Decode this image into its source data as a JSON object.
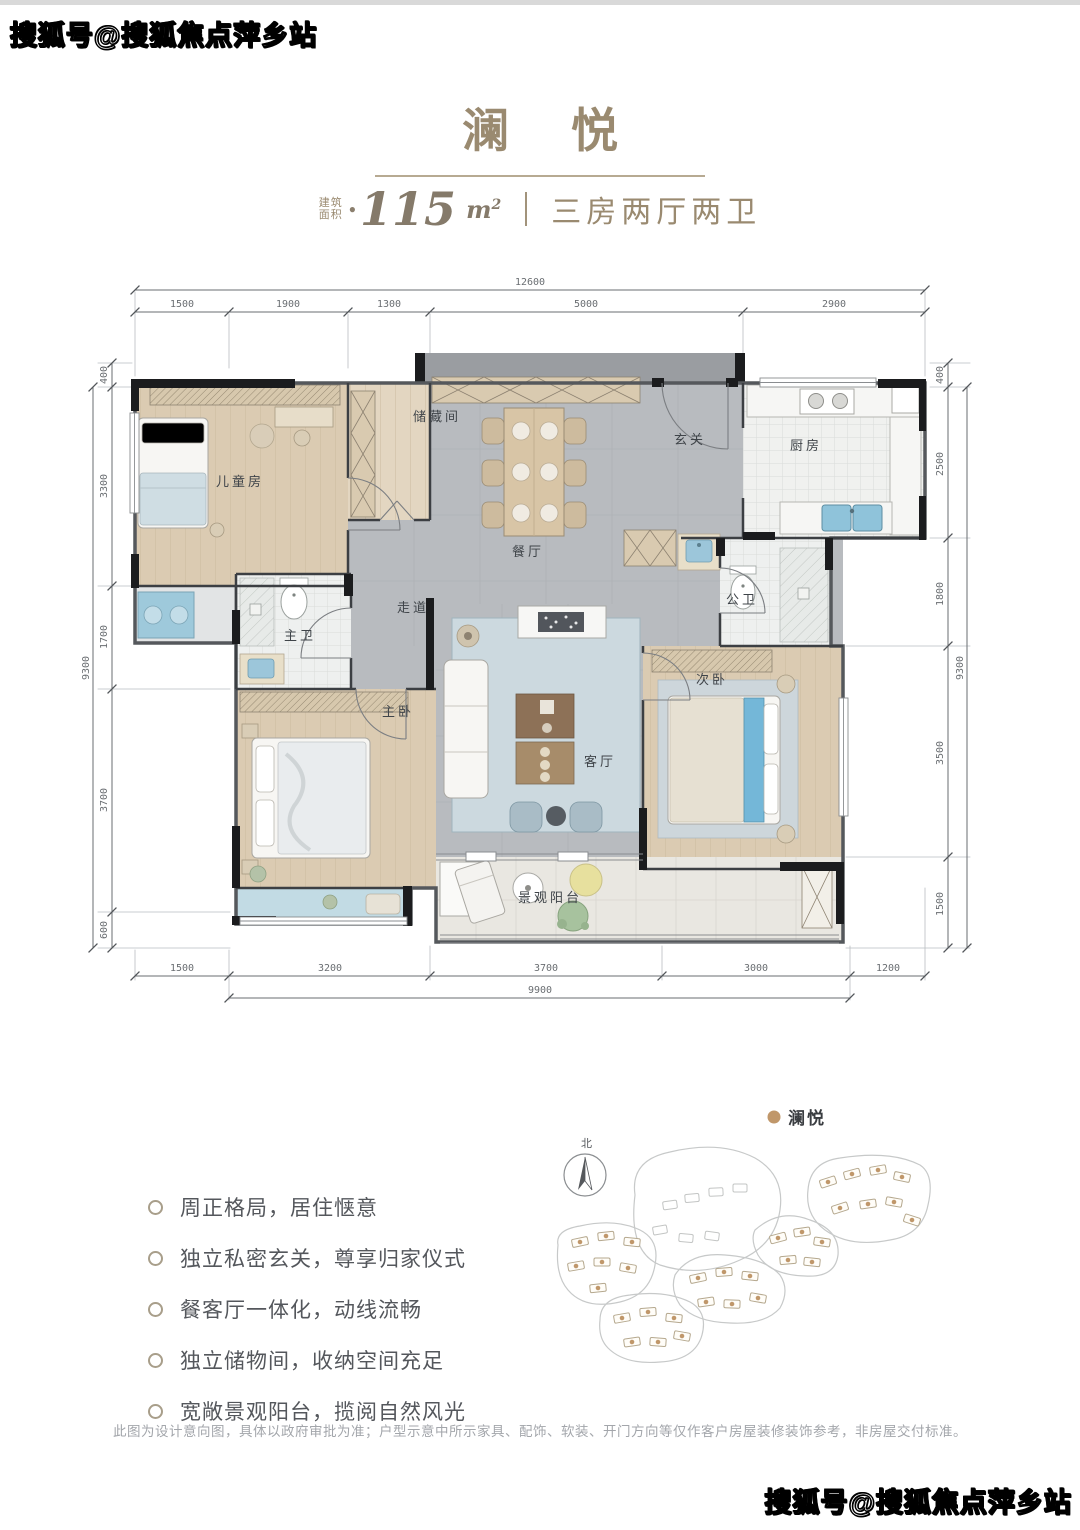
{
  "watermarks": {
    "top_left": "搜狐号@搜狐焦点萍乡站",
    "bottom_right": "搜狐号@搜狐焦点萍乡站"
  },
  "header": {
    "title_char1": "澜",
    "title_char2": "悦",
    "area_label_line1": "建筑",
    "area_label_line2": "面积",
    "area_dot": "●",
    "area_number": "115",
    "area_unit": "m",
    "area_sup": "2",
    "layout_text": "三房两厅两卫"
  },
  "plan": {
    "rooms": {
      "children_room": "儿童房",
      "storage": "储藏间",
      "foyer": "玄关",
      "kitchen": "厨房",
      "dining": "餐厅",
      "corridor": "走道",
      "master_bath": "主卫",
      "guest_bath": "公卫",
      "master_bedroom": "主卧",
      "living": "客厅",
      "second_bedroom": "次卧",
      "balcony": "景观阳台"
    },
    "dims": {
      "top_total": "12600",
      "top": [
        "1500",
        "1900",
        "1300",
        "5000",
        "2900"
      ],
      "bottom": [
        "1500",
        "3200",
        "3700",
        "3000",
        "1200"
      ],
      "bottom_total": "9900",
      "left": [
        "400",
        "3300",
        "1700",
        "3700",
        "600"
      ],
      "left_total": "9300",
      "right": [
        "400",
        "2500",
        "1800",
        "3500",
        "1500"
      ],
      "right_total": "9300"
    }
  },
  "features": {
    "items": [
      "周正格局，居住惬意",
      "独立私密玄关，尊享归家仪式",
      "餐客厅一体化，动线流畅",
      "独立储物间，收纳空间充足",
      "宽敞景观阳台，揽阅自然风光"
    ]
  },
  "siteplan": {
    "legend_label": "澜悦",
    "north_label": "北"
  },
  "disclaimer": "此图为设计意向图，具体以政府审批为准；户型示意中所示家具、配饰、软装、开门方向等仅作客户房屋装修装饰参考，非房屋交付标准。"
}
